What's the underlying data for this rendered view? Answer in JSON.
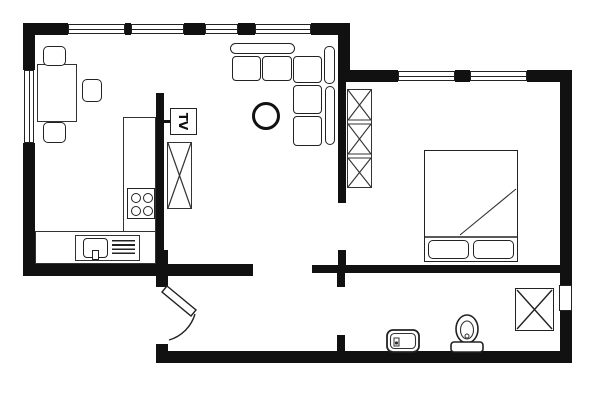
{
  "floor_plan": {
    "title": "apartment-floor-plan",
    "colors": {
      "background": "#ffffff",
      "walls": "#111111",
      "outline": "#222222"
    },
    "labels": {
      "tv": "TV"
    },
    "rooms": [
      "kitchen-dining",
      "living-room",
      "bedroom",
      "hallway",
      "bathroom"
    ],
    "furniture": [
      "dining-table",
      "dining-chair-top",
      "dining-chair-right",
      "dining-chair-bottom",
      "kitchen-counter-l-shape",
      "stove-4-burners",
      "kitchen-sink-with-drainer",
      "tall-cabinet-x",
      "wall-tv",
      "corner-sofa",
      "round-coffee-table",
      "bedroom-wardrobe-3-sections",
      "double-bed-with-two-pillows",
      "shower-cabin",
      "toilet",
      "bathroom-sink"
    ],
    "openings": [
      "entrance-door-swing",
      "living-hallway-opening",
      "bedroom-door-opening",
      "bathroom-door-opening"
    ],
    "windows": {
      "top_wall_count": 4,
      "left_wall_count": 1,
      "bedroom_top_wall_count": 2,
      "bathroom_right_niche": 1
    }
  }
}
